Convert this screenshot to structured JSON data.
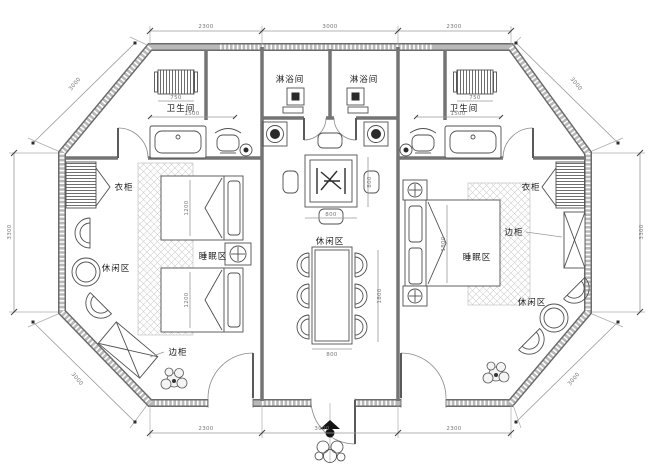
{
  "colors": {
    "wall": "#8f8f8f",
    "wall_edge": "#6b6b6b",
    "line": "#555555",
    "dim": "#888888",
    "background": "#ffffff"
  },
  "labels": {
    "shower_left": "淋浴间",
    "shower_right": "淋浴间",
    "bath_left": "卫生间",
    "bath_right": "卫生间",
    "wardrobe_left": "衣柜",
    "wardrobe_right": "衣柜",
    "sleep_left": "睡眠区",
    "sleep_right": "睡眠区",
    "leisure_left": "休闲区",
    "leisure_center": "休闲区",
    "leisure_right": "休闲区",
    "cabinet_left": "边柜",
    "cabinet_right": "边柜"
  },
  "dims": {
    "top": [
      "2300",
      "3000",
      "2300"
    ],
    "bottom": [
      "2300",
      "3000",
      "2300"
    ],
    "left": "3300",
    "right": "3300",
    "diag_top_left": "3000",
    "diag_top_right": "3000",
    "diag_bottom_left": "3000",
    "diag_bottom_right": "3000",
    "inner": {
      "bath_left": "1500",
      "bath_right": "1500",
      "towel_left": "750",
      "towel_right": "750",
      "square_table_w": "800",
      "square_table_h": "800",
      "dining_w": "800",
      "dining_l": "1800",
      "bed_left_a": "1200",
      "bed_left_b": "1200",
      "bed_right": "1800"
    }
  }
}
